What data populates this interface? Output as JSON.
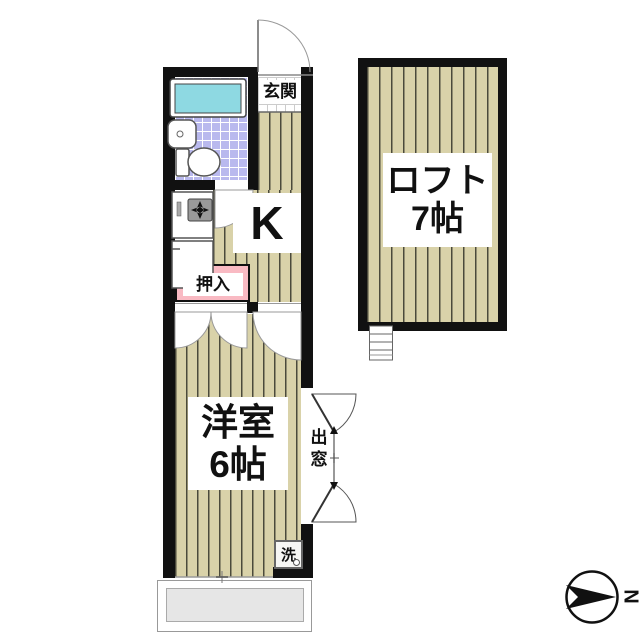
{
  "plan": {
    "entrance_label": "玄関",
    "kitchen_label": "K",
    "closet_label": "押入",
    "main_room_line1": "洋室",
    "main_room_line2": "6帖",
    "loft_line1": "ロフト",
    "loft_line2": "7帖",
    "bay_window_char1": "出",
    "bay_window_char2": "窓",
    "washer_label": "洗",
    "compass_label": "N"
  },
  "colors": {
    "wall": "#111111",
    "wood_floor": "#d9d2a9",
    "bath_tile": "#b9b9ee",
    "bathtub": "#8ed9e2",
    "closet_pink": "#f9bac3",
    "balcony_gray": "#e6e6e6"
  }
}
